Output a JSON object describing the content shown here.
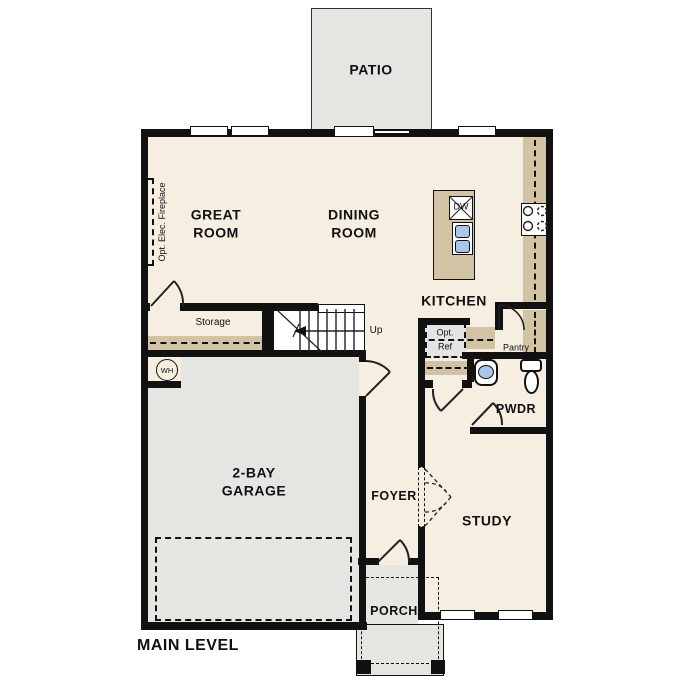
{
  "plan_title": "MAIN LEVEL",
  "rooms": {
    "patio": "PATIO",
    "great_room": "GREAT\nROOM",
    "dining_room": "DINING\nROOM",
    "kitchen": "KITCHEN",
    "storage": "Storage",
    "pantry": "Pantry",
    "pwdr": "PWDR",
    "garage": "2-BAY\nGARAGE",
    "foyer": "FOYER",
    "study": "STUDY",
    "porch": "PORCH"
  },
  "annotations": {
    "up": "Up",
    "opt_fireplace": "Opt. Elec. Fireplace",
    "opt_ref": "Opt.\nRef",
    "water_heater": "WH",
    "dishwasher": "DW",
    "main_level": "MAIN LEVEL"
  },
  "colors": {
    "floor": "#f6eee0",
    "exterior_concrete": "#e5e5e2",
    "counter": "#d2c3a4",
    "fixture_blue": "#a9c7e9",
    "wall": "#111111"
  }
}
